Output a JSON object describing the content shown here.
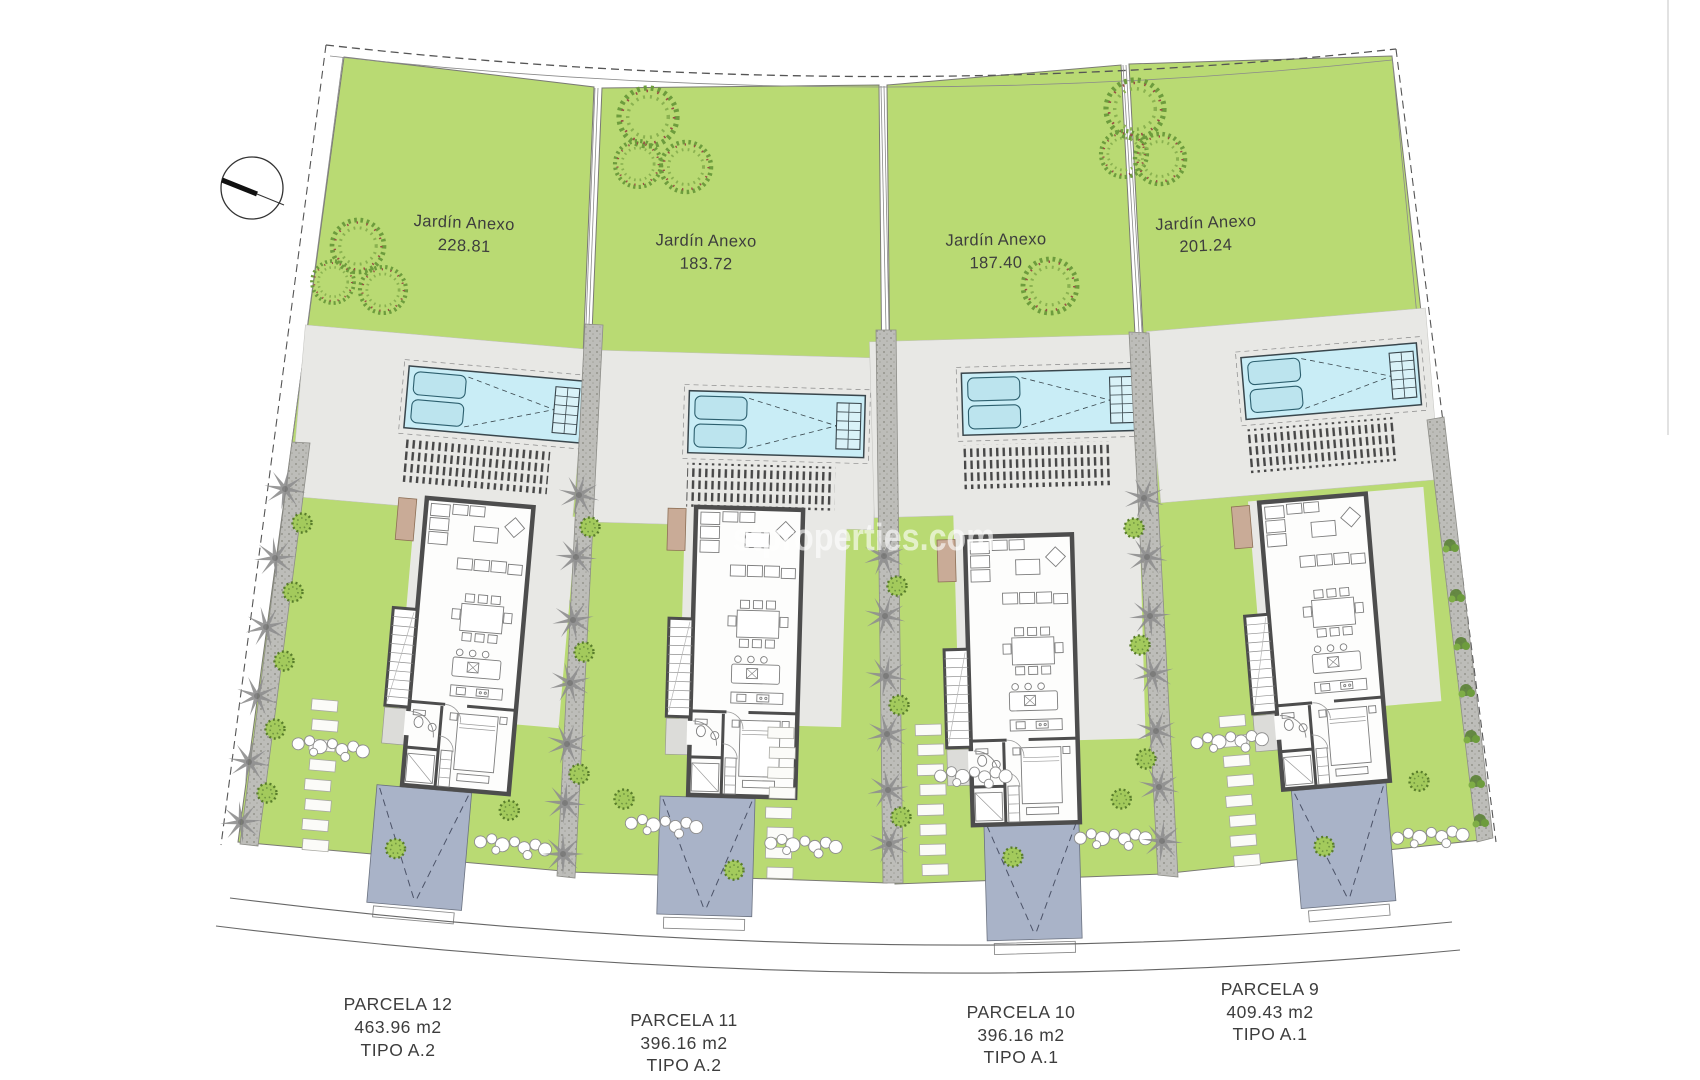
{
  "plan": {
    "watermark": "stproperties.com",
    "compass": {
      "icon": "north-arrow-icon"
    },
    "gardens": [
      {
        "label": "Jardín Anexo",
        "area": "228.81"
      },
      {
        "label": "Jardín Anexo",
        "area": "183.72"
      },
      {
        "label": "Jardín Anexo",
        "area": "187.40"
      },
      {
        "label": "Jardín Anexo",
        "area": "201.24"
      }
    ],
    "parcels": [
      {
        "name": "PARCELA 12",
        "area": "463.96 m2",
        "type": "TIPO A.2"
      },
      {
        "name": "PARCELA 11",
        "area": "396.16 m2",
        "type": "TIPO A.2"
      },
      {
        "name": "PARCELA 10",
        "area": "396.16 m2",
        "type": "TIPO A.1"
      },
      {
        "name": "PARCELA 9",
        "area": "409.43 m2",
        "type": "TIPO A.1"
      }
    ],
    "colors": {
      "garden_green": "#b9da73",
      "pool_cyan": "#c9edf6",
      "driveway_slate": "#a9b3c8",
      "terrace_gray": "#e8e8e5",
      "wall_dark": "#4d4d4d"
    }
  }
}
